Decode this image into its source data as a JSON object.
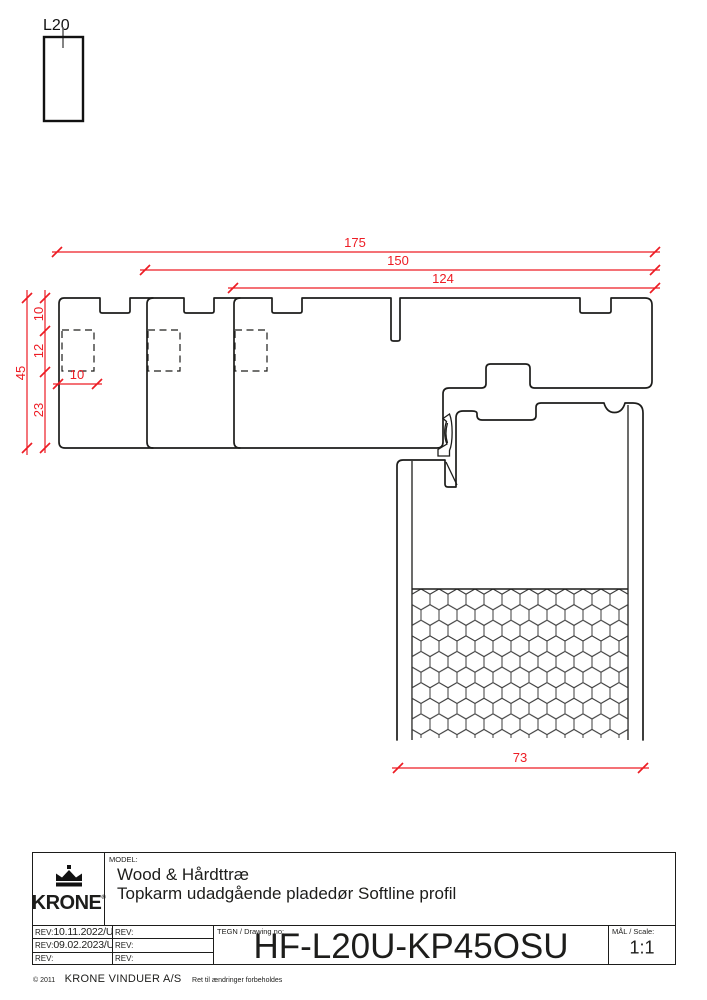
{
  "colors": {
    "dimension_red": "#ED1C24",
    "line_black": "#1d1d1b",
    "background": "#ffffff"
  },
  "cut_symbol": {
    "label": "L20"
  },
  "dimensions": {
    "overall_width": "175",
    "width_150": "150",
    "width_124": "124",
    "overall_height": "45",
    "seg_top": "10",
    "seg_mid": "12",
    "seg_bottom": "23",
    "groove_width": "10",
    "door_thickness": "73"
  },
  "title_block": {
    "logo_text": "KRONE",
    "logo_reg": "®",
    "model_label": "MODEL:",
    "model_line1": "Wood & Hårdttræ",
    "model_line2": "Topkarm udadgående pladedør Softline profil",
    "rev_rows": [
      {
        "left_label": "REV:",
        "left_value": "10.11.2022/UK",
        "right_label": "REV:"
      },
      {
        "left_label": "REV:",
        "left_value": "09.02.2023/UK",
        "right_label": "REV:"
      },
      {
        "left_label": "REV:",
        "left_value": "",
        "right_label": "REV:"
      }
    ],
    "tegn_label": "TEGN / Drawing no:",
    "drawing_no": "HF-L20U-KP45OSU",
    "scale_label": "MÅL / Scale:",
    "scale_value": "1:1",
    "copyright": "© 2011",
    "company": "KRONE VINDUER A/S",
    "rights": "Ret til ændringer forbeholdes"
  }
}
